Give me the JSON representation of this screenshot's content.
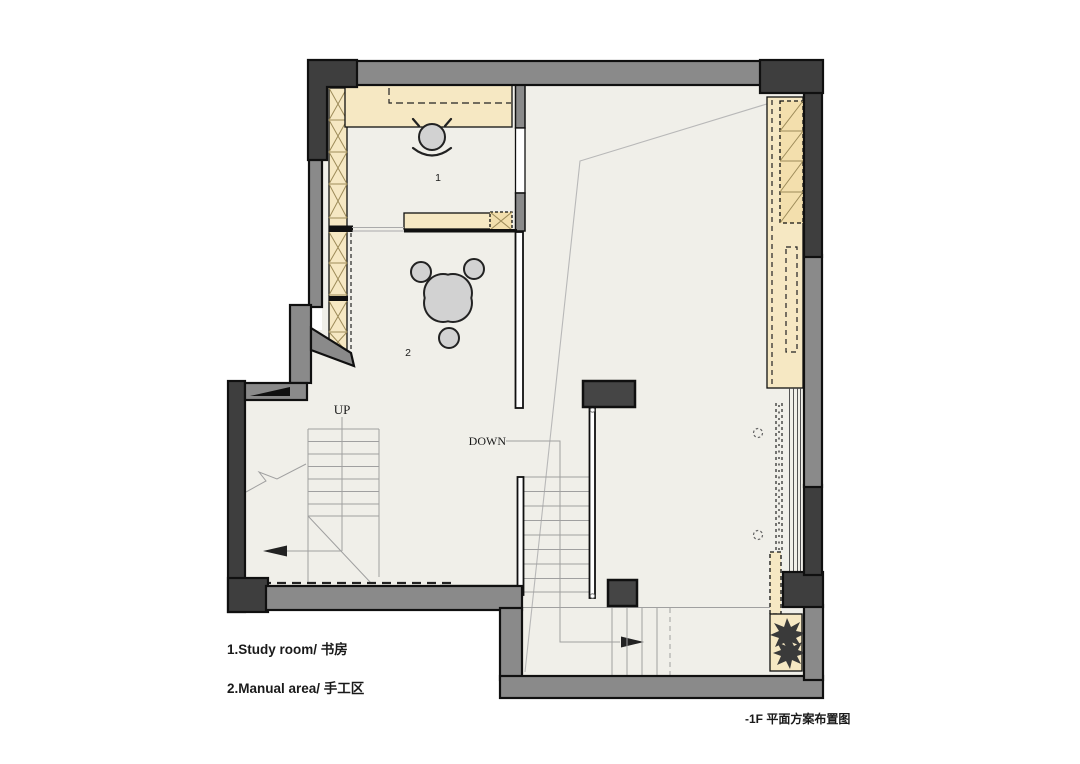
{
  "caption": "-1F 平面方案布置图",
  "legend": {
    "items": [
      {
        "label": "1.Study room/ 书房"
      },
      {
        "label": "2.Manual area/ 手工区"
      }
    ]
  },
  "plan": {
    "up_label": "UP",
    "down_label": "DOWN",
    "room_numbers": {
      "study": "1",
      "manual": "2"
    }
  },
  "colors": {
    "wall_gray": "#8a8a8a",
    "wall_dark": "#3e3e3e",
    "wall_outline": "#101010",
    "cabinet_fill": "#f6e8c3",
    "cabinet_hatch": "#f3dfad",
    "hatch_line": "#9d8b59",
    "floor": "#f0efe9",
    "furniture_fill": "#d2d2d2",
    "furniture_outline": "#222222",
    "stair_line": "#a0a0a0",
    "ceiling_line": "#b8b8b8",
    "dash_dark": "#222222",
    "column_fill": "#454545",
    "text": "#1a1a1a"
  }
}
